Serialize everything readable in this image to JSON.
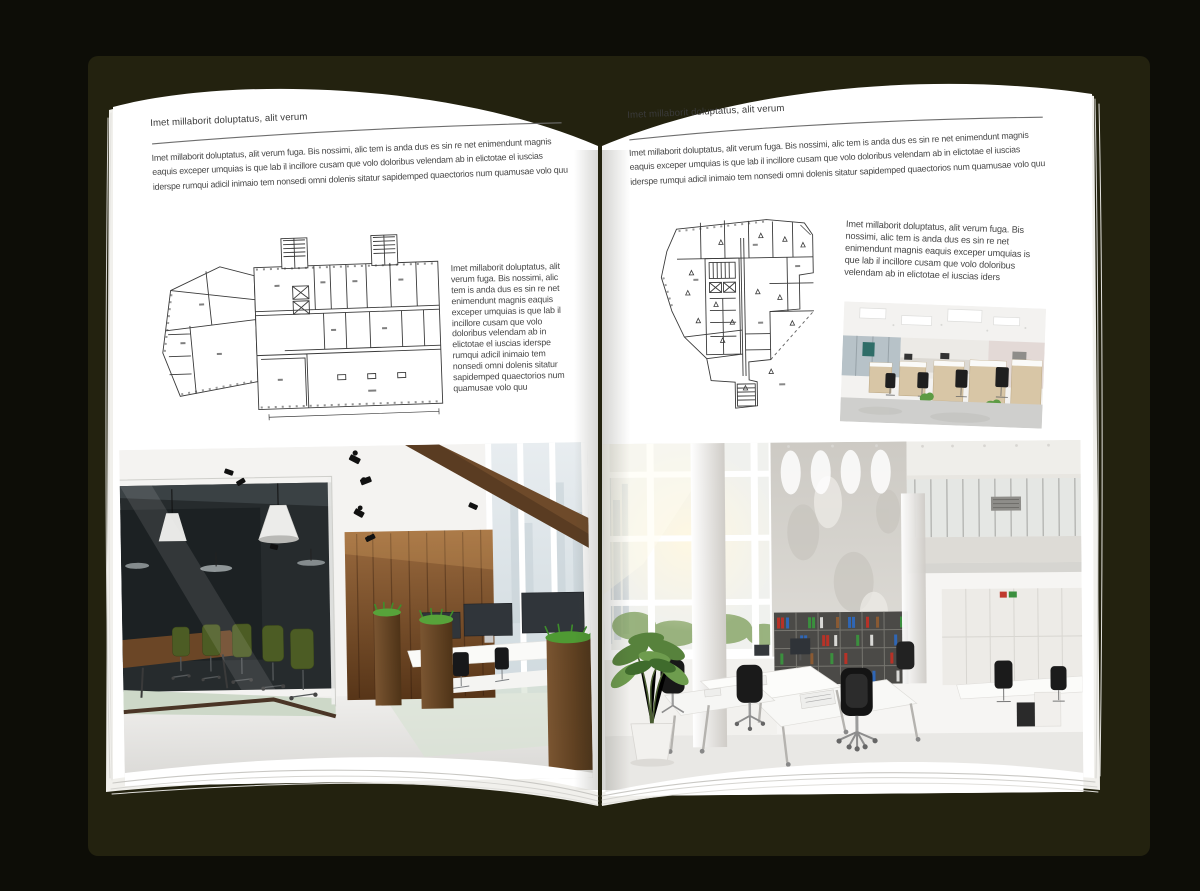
{
  "colors": {
    "background": "#0d0d07",
    "cover": "#23220f",
    "page": "#ffffff",
    "text": "#474747",
    "rule": "#6e6e6e",
    "plan_line": "#3a3a3a",
    "wood": "#6e4a2a",
    "plant_green": "#4f8f2f"
  },
  "left_page": {
    "header": "Imet millaborit doluptatus, alit verum",
    "intro": "Imet millaborit doluptatus, alit verum fuga. Bis nossimi, alic tem is anda dus es sin re net enimendunt magnis eaquis exceper umquias is que lab il incillore cusam que volo doloribus velendam ab in elictotae el iuscias iderspe rumqui adicil inimaio tem nonsedi omni dolenis sitatur sapidemped quaectorios num quamusae volo quu",
    "side_paragraph": "Imet millaborit doluptatus, alit verum fuga. Bis nossimi, alic tem is anda dus es sin re net enimendunt magnis eaquis exceper umquias is que lab il incillore cusam que volo doloribus velendam ab in elictotae el iuscias iderspe rumqui adicil inimaio tem nonsedi omni dolenis sitatur sapidemped quaectorios num quamusae volo quu",
    "floor_plan": "wide-building-floor-plan-with-two-stair-towers",
    "photo": "office-interior-dark-glass-meeting-room-green-chairs-wood-wall-desks"
  },
  "right_page": {
    "header": "Imet millaborit doluptatus, alit verum",
    "intro": "Imet millaborit doluptatus, alit verum fuga. Bis nossimi, alic tem is anda dus es sin re net enimendunt magnis eaquis exceper umquias is que lab il incillore cusam que volo doloribus velendam ab in elictotae el iuscias iderspe rumqui adicil inimaio tem nonsedi omni dolenis sitatur sapidemped quaectorios num quamusae volo quu",
    "side_paragraph": "Imet millaborit doluptatus, alit verum fuga. Bis nossimi, alic tem is anda dus es sin re net enimendunt magnis eaquis exceper umquias is que lab il incillore cusam que volo doloribus velendam ab in elictotae el iuscias iders",
    "floor_plan": "irregular-angular-floor-plan-with-core",
    "photo_small": "open-office-cubicle-workstations-interior",
    "photo_large": "bright-double-height-white-office-interior-with-bookshelves"
  }
}
